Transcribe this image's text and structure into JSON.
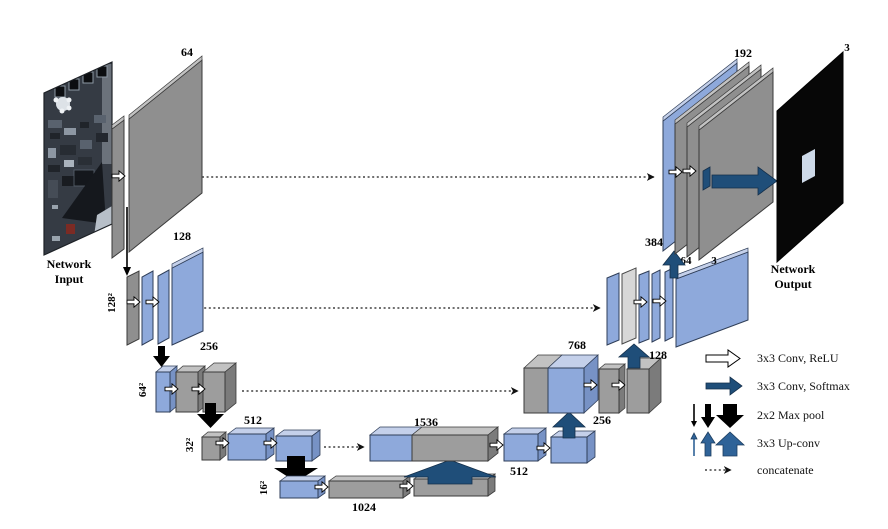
{
  "diagram_type": "U-Net architecture",
  "input": {
    "caption_line1": "Network",
    "caption_line2": "Input"
  },
  "output": {
    "caption_line1": "Network",
    "caption_line2": "Output",
    "channels": "3"
  },
  "encoder": {
    "level1": {
      "channels": "64"
    },
    "level2": {
      "channels": "128",
      "size": "128²"
    },
    "level3": {
      "channels": "256",
      "size": "64²"
    },
    "level4": {
      "channels": "512",
      "size": "32²"
    },
    "bottleneck": {
      "channels": "1024",
      "size": "16²"
    }
  },
  "decoder": {
    "level4": {
      "concat": "1536",
      "out": "512",
      "up": "256"
    },
    "level3": {
      "concat": "768",
      "up": "128"
    },
    "level2": {
      "concat": "384",
      "out_a": "64",
      "out_b": "3"
    },
    "level1": {
      "concat": "192"
    }
  },
  "legend": {
    "conv_relu": "3x3 Conv, ReLU",
    "conv_softmax": "3x3 Conv, Softmax",
    "max_pool": "2x2 Max pool",
    "up_conv": "3x3 Up-conv",
    "concatenate": "concatenate"
  },
  "colors": {
    "feature_blue": "#8ea9db",
    "feature_gray": "#909090",
    "silver": "#d7d7d7",
    "arrow_navy": "#1f4e79",
    "upconv_blue": "#2f6398",
    "output_black": "#0a0a0a"
  }
}
